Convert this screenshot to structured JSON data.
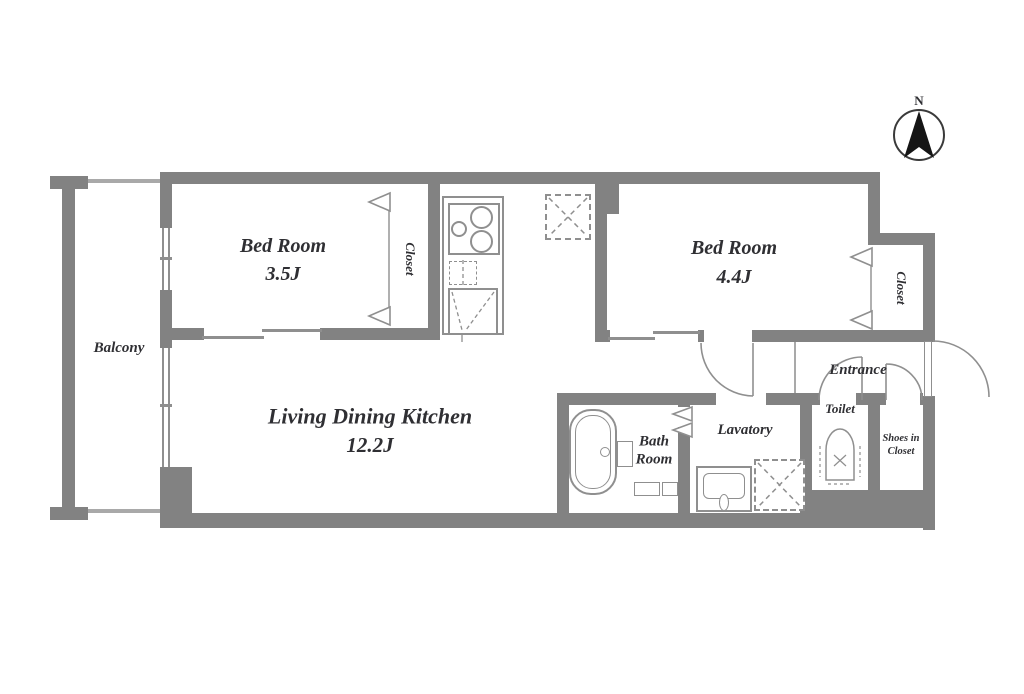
{
  "colors": {
    "wall": "#828282",
    "line": "#8f8f8f",
    "text": "#2f2f33",
    "compass_needle": "#151515"
  },
  "compass": {
    "label": "N"
  },
  "rooms": {
    "balcony": {
      "label": "Balcony"
    },
    "bedroom1": {
      "name": "Bed Room",
      "size": "3.5J"
    },
    "closet1": {
      "label": "Closet"
    },
    "bedroom2": {
      "name": "Bed Room",
      "size": "4.4J"
    },
    "closet2": {
      "label": "Closet"
    },
    "ldk": {
      "name": "Living Dining Kitchen",
      "size": "12.2J"
    },
    "bath": {
      "label": "Bath\nRoom"
    },
    "lavatory": {
      "label": "Lavatory"
    },
    "toilet": {
      "label": "Toilet"
    },
    "shoes": {
      "label": "Shoes in\nCloset"
    },
    "entrance": {
      "label": "Entrance"
    }
  },
  "fixtures": [
    "north-compass",
    "gas-stove",
    "kitchen-sink",
    "refrigerator-space",
    "bathtub",
    "wash-basin",
    "washing-machine-space",
    "toilet-bowl",
    "entrance-door-swing",
    "toilet-door-swing",
    "shoes-closet-door-swing",
    "hall-door-swing",
    "folding-closet-doors",
    "sliding-doors",
    "balcony-railing",
    "windows"
  ]
}
